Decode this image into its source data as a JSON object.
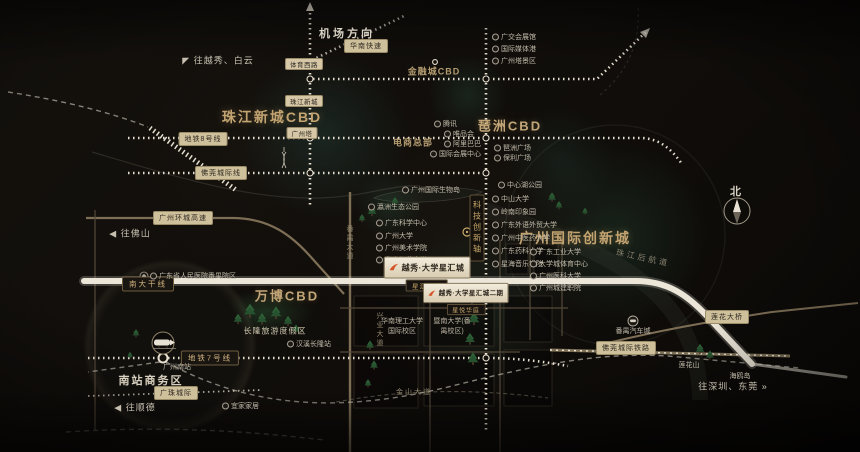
{
  "colors": {
    "accent_gold": "#c3a471",
    "road_light": "#efe9db",
    "road_tan": "#7d6e55",
    "ribbon_bg": "#cfc09c",
    "ink": "#15110d",
    "tree_green": "#2e6137",
    "glow_teal": "#2c564c",
    "logo_orange": "#d4552a"
  },
  "project": {
    "badge1": {
      "title": "越秀·大学星汇城",
      "sub": "星汇华庭"
    },
    "badge2": {
      "title": "越秀·大学星汇城二期",
      "sub": "星悦华庭"
    }
  },
  "labels": [
    {
      "n": "cbd-zhujiang-new-town",
      "t": "珠江新城CBD",
      "x": 272,
      "y": 117,
      "c": "cbd-xl"
    },
    {
      "n": "cbd-pazhou",
      "t": "琶洲CBD",
      "x": 510,
      "y": 125,
      "c": "cbd-lg"
    },
    {
      "n": "cbd-financial-city",
      "t": "金融城CBD",
      "x": 434,
      "y": 71,
      "c": "cbd-md"
    },
    {
      "n": "ecommerce-hq",
      "t": "电商总部",
      "x": 413,
      "y": 142,
      "c": "cbd-md"
    },
    {
      "n": "cbd-innovation-city",
      "t": "广州国际创新城",
      "x": 575,
      "y": 238,
      "c": "cbd-xl"
    },
    {
      "n": "cbd-wanbo",
      "t": "万博CBD",
      "x": 287,
      "y": 295,
      "c": "cbd-lg"
    },
    {
      "n": "south-station-biz-district",
      "t": "南站商务区",
      "x": 151,
      "y": 380,
      "c": "area"
    },
    {
      "n": "changlong-resort",
      "t": "长隆旅游度假区",
      "x": 275,
      "y": 331,
      "c": "area-sm"
    },
    {
      "n": "dir-yuexiu-baiyun",
      "t": "◤ 往越秀、白云",
      "x": 218,
      "y": 60,
      "c": "dir"
    },
    {
      "n": "dir-airport",
      "t": "机场方向",
      "x": 347,
      "y": 33,
      "c": "dir-b"
    },
    {
      "n": "dir-foshan",
      "t": "◀ 往佛山",
      "x": 130,
      "y": 233,
      "c": "dir"
    },
    {
      "n": "dir-shunde",
      "t": "◀ 往顺德",
      "x": 135,
      "y": 407,
      "c": "dir"
    },
    {
      "n": "dir-shenzhen-dongguan",
      "t": "往深圳、东莞 »",
      "x": 733,
      "y": 386,
      "c": "dir"
    },
    {
      "n": "compass-north-label",
      "t": "北",
      "x": 737,
      "y": 191,
      "c": "dir-b"
    },
    {
      "n": "pearl-river-rear-channel",
      "t": "珠江后航道",
      "x": 643,
      "y": 258,
      "c": "river",
      "r": 12
    },
    {
      "n": "ribbon-metro-line-8",
      "t": "地铁8号线",
      "x": 203,
      "y": 139,
      "c": "pill"
    },
    {
      "n": "ribbon-foguan-intercity",
      "t": "佛莞城际线",
      "x": 221,
      "y": 173,
      "c": "pill"
    },
    {
      "n": "ribbon-nanda-trunk",
      "t": "南大干线",
      "x": 148,
      "y": 284,
      "c": "pilld"
    },
    {
      "n": "ribbon-metro-line-7",
      "t": "地铁7号线",
      "x": 210,
      "y": 358,
      "c": "pilld"
    },
    {
      "n": "ribbon-guangzhu-intercity",
      "t": "广珠城际",
      "x": 176,
      "y": 393,
      "c": "pill"
    },
    {
      "n": "ribbon-ring-expressway",
      "t": "广州环城高速",
      "x": 183,
      "y": 218,
      "c": "pill"
    },
    {
      "n": "ribbon-huanan-expressway",
      "t": "华南快速",
      "x": 366,
      "y": 46,
      "c": "pill"
    },
    {
      "n": "station-tiyu-xilu",
      "t": "体育西路",
      "x": 304,
      "y": 64,
      "c": "pill-sm"
    },
    {
      "n": "station-zhujiang-new-town",
      "t": "珠江新城",
      "x": 304,
      "y": 101,
      "c": "pill-sm"
    },
    {
      "n": "station-canton-tower",
      "t": "广州塔",
      "x": 302,
      "y": 133,
      "c": "pill-sm"
    },
    {
      "n": "ribbon-lianhua-bridge",
      "t": "莲花大桥",
      "x": 727,
      "y": 317,
      "c": "pill"
    },
    {
      "n": "ribbon-foguan-railway",
      "t": "佛莞城际铁路",
      "x": 626,
      "y": 348,
      "c": "pill"
    },
    {
      "n": "poi-canton-fair-hall",
      "t": "广交会展馆",
      "x": 492,
      "y": 37,
      "c": "poi"
    },
    {
      "n": "poi-media-port",
      "t": "国际媒体港",
      "x": 492,
      "y": 49,
      "c": "poi"
    },
    {
      "n": "poi-canton-tower-area",
      "t": "广州塔景区",
      "x": 492,
      "y": 61,
      "c": "poi"
    },
    {
      "n": "poi-pazhou-plaza",
      "t": "琶洲广场",
      "x": 494,
      "y": 148,
      "c": "poi"
    },
    {
      "n": "poi-poly-plaza",
      "t": "保利广场",
      "x": 494,
      "y": 158,
      "c": "poi"
    },
    {
      "n": "poi-tencent",
      "t": "腾讯",
      "x": 434,
      "y": 124,
      "c": "poi"
    },
    {
      "n": "poi-vipshop",
      "t": "唯品会",
      "x": 444,
      "y": 134,
      "c": "poi"
    },
    {
      "n": "poi-alibaba",
      "t": "阿里巴巴",
      "x": 444,
      "y": 144,
      "c": "poi"
    },
    {
      "n": "poi-intl-exhibition-center",
      "t": "国际会展中心",
      "x": 430,
      "y": 154,
      "c": "poi"
    },
    {
      "n": "poi-bio-island",
      "t": "广州国际生物岛",
      "x": 402,
      "y": 190,
      "c": "poi"
    },
    {
      "n": "poi-yingzhou-eco-park",
      "t": "瀛洲生态公园",
      "x": 368,
      "y": 207,
      "c": "poi"
    },
    {
      "n": "poi-gd-science-center",
      "t": "广东科学中心",
      "x": 376,
      "y": 223,
      "c": "poi"
    },
    {
      "n": "poi-guangzhou-university",
      "t": "广州大学",
      "x": 376,
      "y": 236,
      "c": "poi"
    },
    {
      "n": "poi-academy-of-fine-arts",
      "t": "广州美术学院",
      "x": 376,
      "y": 248,
      "c": "poi"
    },
    {
      "n": "poi-south-china-normal-univ",
      "t": "华南师范大学",
      "x": 376,
      "y": 260,
      "c": "poi"
    },
    {
      "n": "poi-central-lake-park",
      "t": "中心湖公园",
      "x": 498,
      "y": 185,
      "c": "poi"
    },
    {
      "n": "poi-sun-yat-sen-university",
      "t": "中山大学",
      "x": 492,
      "y": 199,
      "c": "poi"
    },
    {
      "n": "poi-lingnan-impression-park",
      "t": "岭南印象园",
      "x": 492,
      "y": 212,
      "c": "poi"
    },
    {
      "n": "poi-gdufs",
      "t": "广东外语外贸大学",
      "x": 492,
      "y": 225,
      "c": "poi"
    },
    {
      "n": "poi-gzucm",
      "t": "广州中医药大学",
      "x": 492,
      "y": 238,
      "c": "poi"
    },
    {
      "n": "poi-gdpu",
      "t": "广东药科大学",
      "x": 492,
      "y": 251,
      "c": "poi"
    },
    {
      "n": "poi-xinghai-conservatory",
      "t": "星海音乐学院",
      "x": 492,
      "y": 264,
      "c": "poi"
    },
    {
      "n": "poi-gdut",
      "t": "广东工业大学",
      "x": 530,
      "y": 252,
      "c": "poi"
    },
    {
      "n": "poi-univ-town-sports-center",
      "t": "大学城体育中心",
      "x": 530,
      "y": 264,
      "c": "poi"
    },
    {
      "n": "poi-gz-medical-university",
      "t": "广州医科大学",
      "x": 530,
      "y": 276,
      "c": "poi"
    },
    {
      "n": "poi-chengjian-college",
      "t": "广州城建职院",
      "x": 530,
      "y": 288,
      "c": "poi"
    },
    {
      "n": "campus-scut-international",
      "t": "华南理工大学国际校区",
      "x": 402,
      "y": 327,
      "c": "campus",
      "w": 46
    },
    {
      "n": "campus-jinan-panyu",
      "t": "暨南大学(番禺校区)",
      "x": 452,
      "y": 327,
      "c": "campus",
      "w": 42
    },
    {
      "n": "poi-guangzhou-south-station",
      "t": "广州南站",
      "x": 177,
      "y": 367,
      "c": "poi-plain"
    },
    {
      "n": "poi-hanxi-changlong-station",
      "t": "汉溪长隆站",
      "x": 287,
      "y": 344,
      "c": "poi"
    },
    {
      "n": "poi-panyu-auto-city",
      "t": "番禺汽车城",
      "x": 633,
      "y": 331,
      "c": "poi-plain"
    },
    {
      "n": "poi-lianhua-mountain",
      "t": "莲花山",
      "x": 689,
      "y": 365,
      "c": "poi-plain"
    },
    {
      "n": "poi-haiou-island",
      "t": "海鸥岛",
      "x": 740,
      "y": 376,
      "c": "poi-plain"
    },
    {
      "n": "poi-ikea",
      "t": "宜家家居",
      "x": 222,
      "y": 406,
      "c": "poi"
    },
    {
      "n": "poi-provincial-hospital-panyu",
      "t": "广东省人民医院番禺院区",
      "x": 150,
      "y": 276,
      "c": "poi"
    },
    {
      "n": "road-panyu-avenue",
      "t": "番禺大道",
      "x": 349,
      "y": 243,
      "c": "road-v"
    },
    {
      "n": "road-xingye-avenue",
      "t": "兴业大道",
      "x": 379,
      "y": 330,
      "c": "road-v"
    },
    {
      "n": "road-jinshan-avenue",
      "t": "金山大道",
      "x": 414,
      "y": 392,
      "c": "road-h"
    },
    {
      "n": "ribbon-tech-innovation-axis",
      "t": "科技创新轴",
      "x": 477,
      "y": 228,
      "c": "axis"
    }
  ]
}
